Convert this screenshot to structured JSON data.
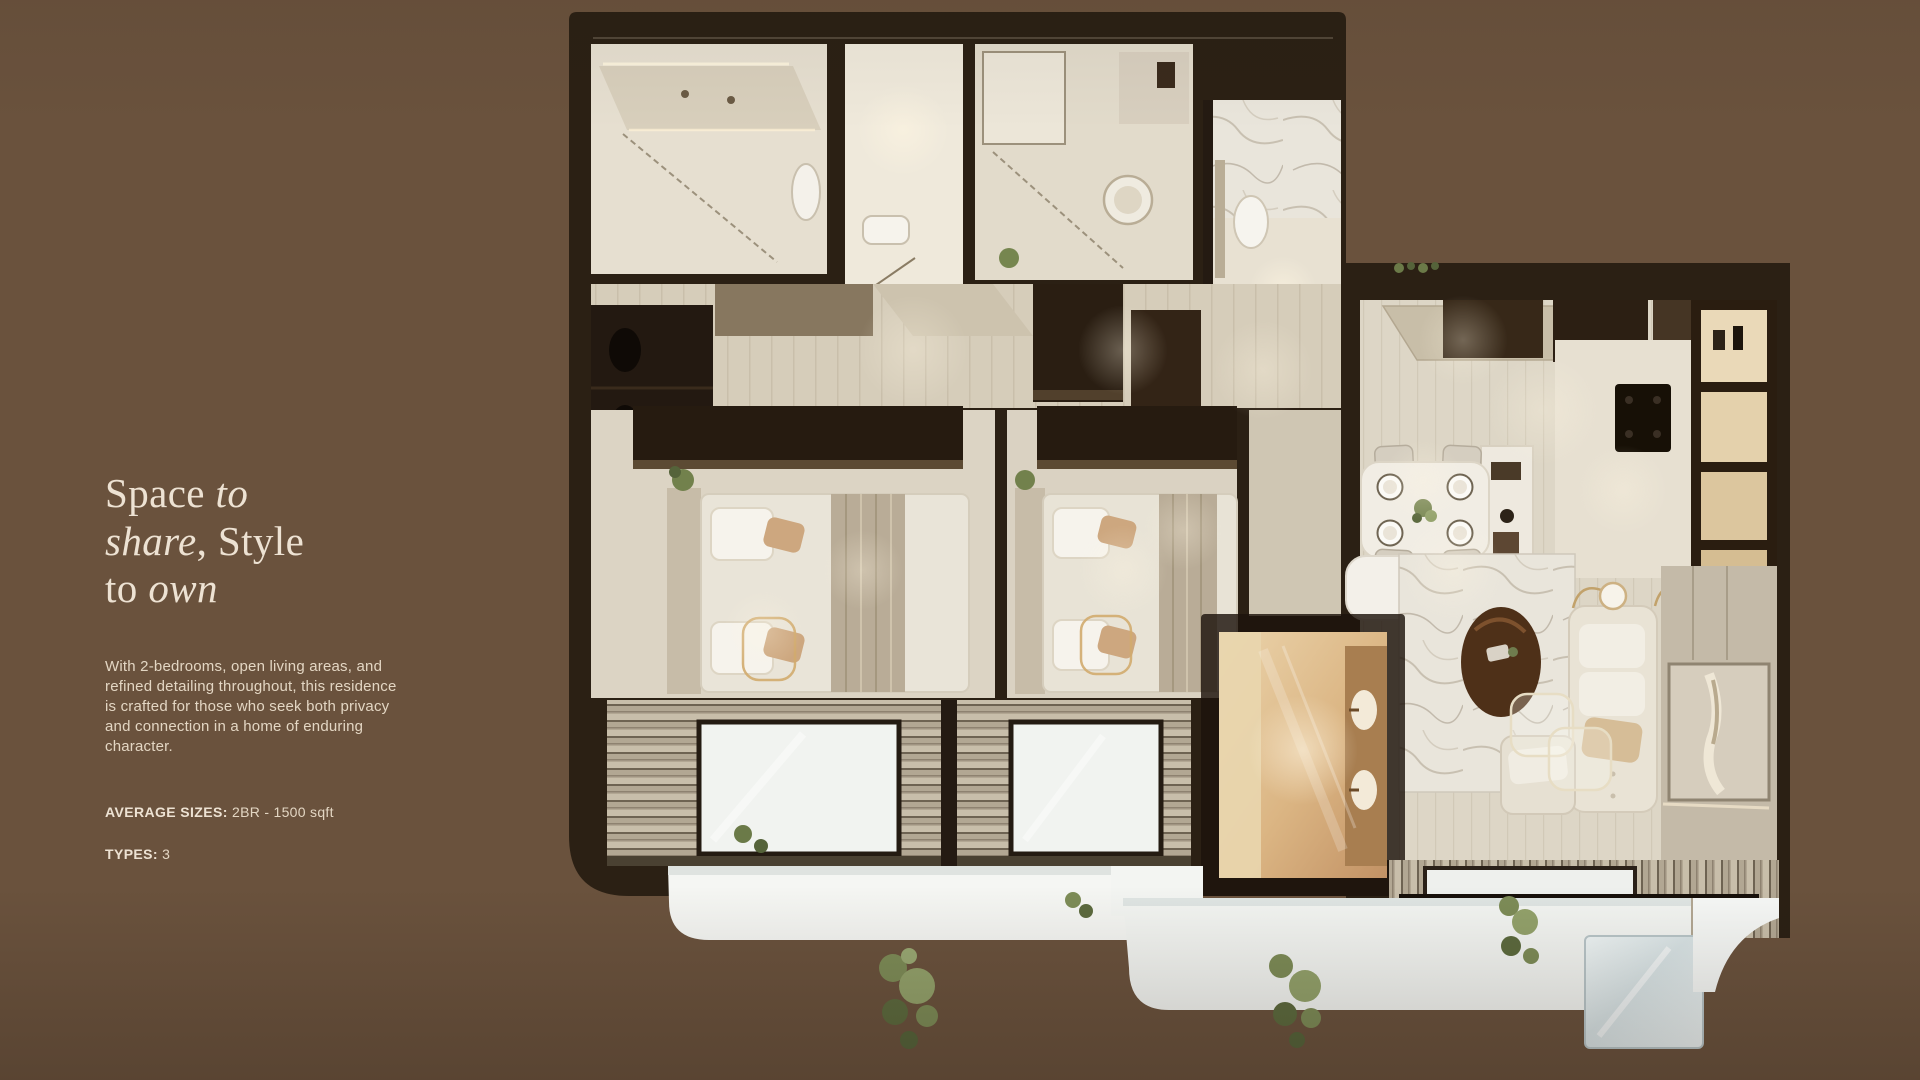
{
  "page": {
    "background_color": "#6A523D",
    "text_color": "#EDE2D3"
  },
  "hero": {
    "heading": {
      "lines": [
        {
          "parts": [
            {
              "text": "Space ",
              "italic": false
            },
            {
              "text": "to",
              "italic": true
            }
          ]
        },
        {
          "parts": [
            {
              "text": "share",
              "italic": true
            },
            {
              "text": ", Style",
              "italic": false
            }
          ]
        },
        {
          "parts": [
            {
              "text": "to ",
              "italic": false
            },
            {
              "text": "own",
              "italic": true
            }
          ]
        }
      ]
    },
    "description": "With 2-bedrooms, open living areas, and refined detailing throughout, this residence is crafted for those who seek both privacy and connection in a home of enduring character.",
    "specs": [
      {
        "label": "AVERAGE SIZES:",
        "value": "2BR - 1500 sqft"
      },
      {
        "label": "TYPES:",
        "value": "3"
      }
    ]
  },
  "floor_plan": {
    "view": "top-down 3d render of a 2-bedroom residence",
    "rooms": [
      "bathroom-1",
      "powder-room",
      "bathroom-2",
      "bathroom-3",
      "wardrobe-corridor",
      "bedroom-1",
      "bedroom-2",
      "ensuite-bathroom",
      "kitchen",
      "dining-area",
      "living-room",
      "balcony-bedroom-1",
      "balcony-bedroom-2",
      "balcony-living"
    ],
    "palette": {
      "walls": "#2B2014",
      "floor": "#DDD5C5",
      "deck": "#B7AB99",
      "ledge": "#F4F6F3",
      "foliage": "#7D8C57",
      "warm_glow": "#E4C89C",
      "gold_accent": "#D2AB6E"
    }
  }
}
